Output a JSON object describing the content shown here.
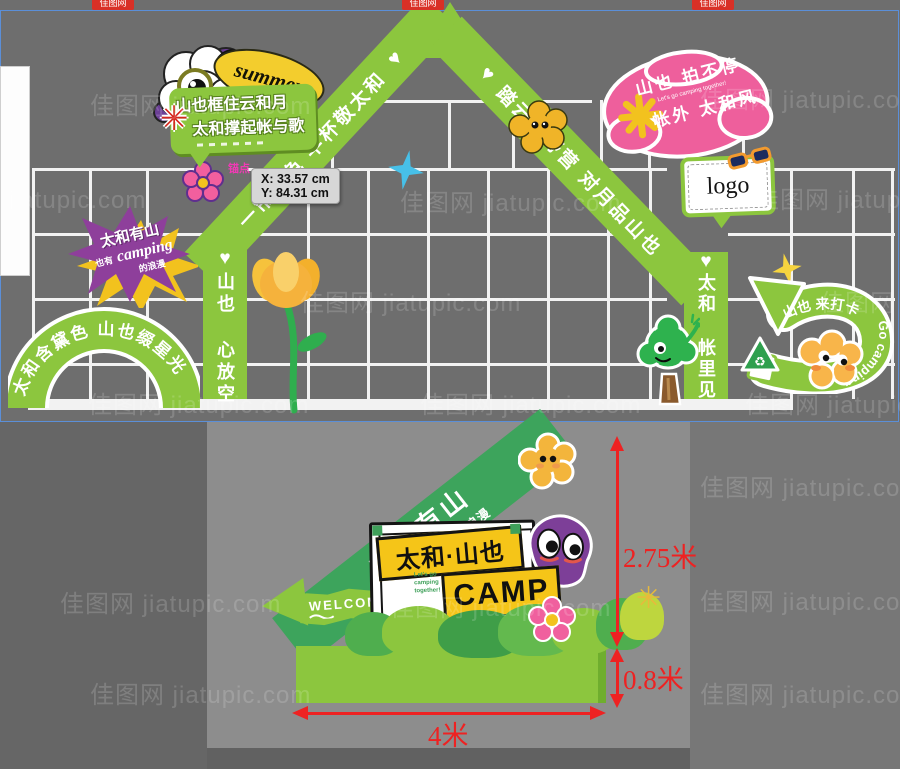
{
  "colors": {
    "arch_green": "#8cc63e",
    "banner_green": "#3da45c",
    "pink_sign": "#ee5f9c",
    "purple": "#8e3f9b",
    "tag_yellow": "#f3cd2d",
    "sign_yellow": "#f5c518",
    "sparkle_blue": "#47c0e8",
    "dimension_red": "#ee2222",
    "panel_border_blue": "#5b8fd8"
  },
  "watermark": {
    "text": "佳图网 jiatupic.com",
    "badge": "佳图网"
  },
  "top_panel": {
    "tooltip": {
      "x": "X: 33.57 cm",
      "y": "Y: 84.31 cm"
    },
    "anchor_label": "锚点",
    "summer_tag": "summer",
    "bubble_sign": {
      "line1": "山也框住云和月",
      "line2": "太和撑起帐与歌"
    },
    "left_diagonal": "一帘山色  半杯敬太和",
    "right_diagonal": "踏云寻野营  对月品山也",
    "left_column": "山也 心放空",
    "right_column": "太和 帐里见",
    "pink_sign": {
      "line1": "山也 拍不停",
      "small": "Let's go camping together!",
      "line2": "帐外 太和风"
    },
    "purple_burst": {
      "line1": "太和有山",
      "line2_prefix": "也有",
      "line2_word": "camping",
      "line3": "的浪漫"
    },
    "logo": "logo",
    "arc_sign": "太和含黛色  山也缀星光",
    "arrow_sign": {
      "cn": "山也 来打卡",
      "en": "Go camping"
    },
    "heart": "♥",
    "recycle": "♻"
  },
  "bottom_panel": {
    "banner": {
      "line1": "太和有山",
      "line2": "也有CAMPING的浪漫"
    },
    "welcome": "WELCOME",
    "camp_sign": {
      "title": "太和·山也",
      "small": "Let's go camping together!",
      "subtitle": "CAMP"
    },
    "dimensions": {
      "total_height": "2.75米",
      "base_height": "0.8米",
      "width": "4米"
    }
  }
}
